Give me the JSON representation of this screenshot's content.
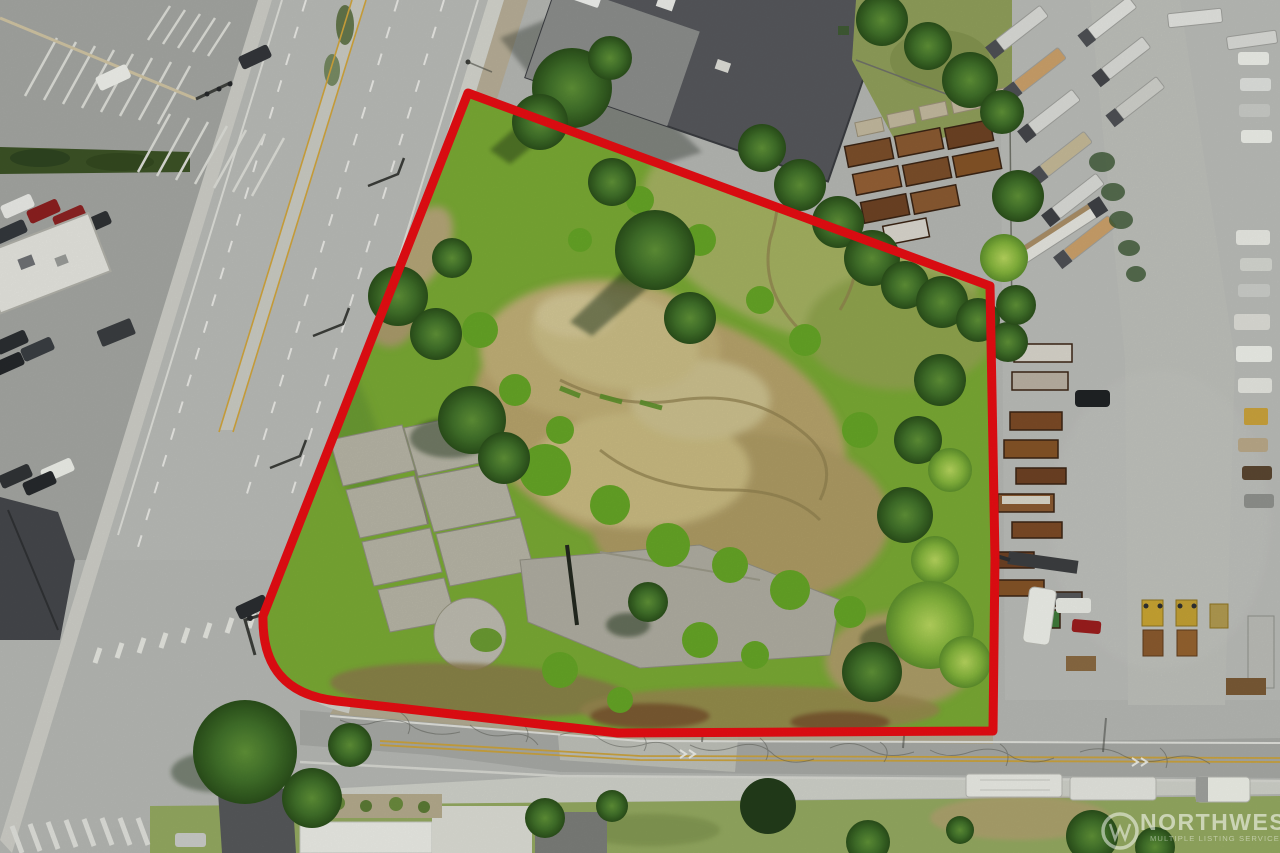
{
  "scene": {
    "type": "aerial-drone-photo",
    "subject": "vacant land parcel outlined in red",
    "surroundings": [
      "arterial road west",
      "cross street south",
      "truck yard east",
      "commercial building north",
      "parking lot northwest"
    ]
  },
  "boundary": {
    "color": "#e60d13",
    "style": "solid thick outline, rounded southwest corner"
  },
  "watermark": {
    "title": "NORTHWEST",
    "subtitle": "MULTIPLE LISTING SERVICE",
    "logo_name": "nwmls-circle-logo",
    "text_color": "#ffffff"
  }
}
